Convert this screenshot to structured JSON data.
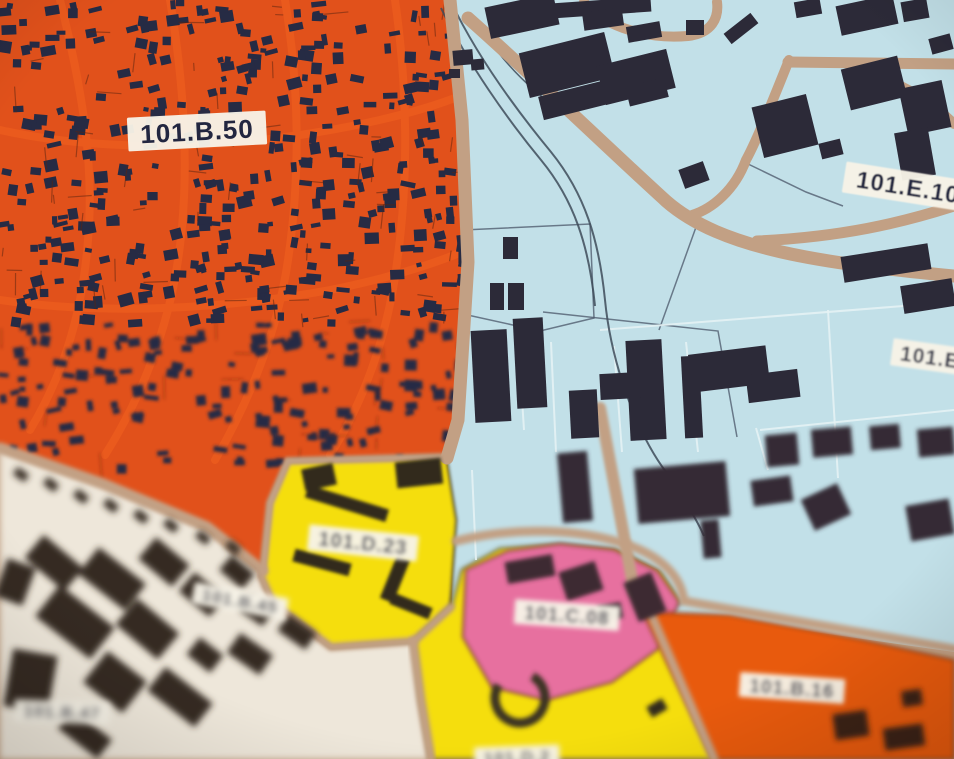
{
  "map": {
    "description": "zoning-map-photo",
    "background_color": "#c2a084",
    "road_color": "#c2a084",
    "railway_color": "#3e4b59",
    "building_color_blue_zone": "#2c2a38",
    "house_color_orange_zone": "#262b44",
    "label_bg_color": "#f7f3e7",
    "label_text_color": "#222640",
    "zones": [
      {
        "id": "zone-residential-orange",
        "color": "#e1511b",
        "points": "0,0 450,0 462,120 468,262 458,420 447,458 288,461 270,503 263,571 207,527 103,484 0,448",
        "blur": 0
      },
      {
        "id": "zone-industrial-blue",
        "color": "#c2e0e8",
        "points": "450,0 954,0 954,652 800,630 651,612 678,601 658,570 614,549 560,545 508,551 466,569 461,632 452,608 453,520 447,458 458,420 468,262 462,120",
        "blur": 0
      },
      {
        "id": "zone-white-101b45",
        "color": "#eee7da",
        "points": "0,448 103,484 207,527 263,571 261,576 273,603 331,647 414,641 421,700 431,759 0,759",
        "blur": 3.5
      },
      {
        "id": "zone-yellow-101d23",
        "color": "#f5de0a",
        "points": "288,461 446,457 456,520 450,607 414,641 331,647 273,603 261,576 263,571 270,503",
        "outline": "#473c20",
        "ow": 2.5,
        "blur": 1.5
      },
      {
        "id": "zone-yellow-lower",
        "color": "#f5de0a",
        "points": "414,641 452,606 462,570 500,549 560,545 616,550 660,572 680,602 651,612 714,759 431,759 421,700",
        "outline": "#473c20",
        "ow": 2.5,
        "blur": 2.5
      },
      {
        "id": "zone-pink-101c08",
        "color": "#e7709f",
        "points": "466,570 508,551 560,544 614,550 657,571 679,602 659,648 612,682 546,700 492,687 463,637",
        "outline": "#8a4a3a",
        "ow": 2.5,
        "blur": 2
      },
      {
        "id": "zone-orange-101b16",
        "color": "#e85a10",
        "points": "643,612 730,615 863,640 954,660 954,759 713,759",
        "outline": "#7a3a14",
        "ow": 2,
        "blur": 2.5
      }
    ],
    "streets_in_orange": [
      {
        "d": "M60,0 C80,80 95,160 88,240 C82,320 60,380 30,430"
      },
      {
        "d": "M170,0 C185,90 190,180 178,260 C168,330 140,400 105,455"
      },
      {
        "d": "M285,0 C300,90 300,180 288,260 C278,330 250,400 215,460"
      },
      {
        "d": "M395,0 C408,90 408,180 398,255 C390,325 368,395 330,455"
      },
      {
        "d": "M0,130 C90,150 200,150 300,135 C360,126 420,112 460,96"
      },
      {
        "d": "M0,300 C100,315 220,310 330,290 C390,278 430,265 462,252"
      }
    ],
    "street_color": "#ea5a1d",
    "texture": {
      "seed": 7,
      "house_count": 540,
      "line_count": 90,
      "line_color": "#5a2410"
    },
    "roads": [
      {
        "d": "M450,0 L462,120 L468,262 L458,420 L447,458",
        "w": 13,
        "blur": 0
      },
      {
        "d": "M0,448 L103,484 L207,527 L263,571",
        "w": 11,
        "blur": 2
      },
      {
        "d": "M263,571 L270,503 L288,461 L446,457",
        "w": 8,
        "blur": 1.5
      },
      {
        "d": "M261,576 L273,603 L331,647 L414,641 L451,607",
        "w": 8,
        "blur": 2
      },
      {
        "d": "M413,641 L421,700 L431,759",
        "w": 9,
        "blur": 2.5
      },
      {
        "d": "M468,18 C540,82 612,152 666,201 C722,250 822,263 954,276",
        "w": 13,
        "blur": 0
      },
      {
        "d": "M757,241 C842,237 901,223 954,206",
        "w": 11,
        "blur": 0
      },
      {
        "d": "M788,62 L954,64",
        "w": 11,
        "blur": 0
      },
      {
        "d": "M850,66 C902,82 932,102 954,124",
        "w": 10,
        "blur": 0
      },
      {
        "d": "M789,60 C775,95 757,140 746,160 C735,190 712,209 692,215",
        "w": 10,
        "blur": 0
      },
      {
        "d": "M584,2 C598,22 640,40 688,36 C712,33 719,18 717,2",
        "w": 10,
        "blur": 0
      },
      {
        "d": "M600,408 L634,590",
        "w": 12,
        "blur": 1.5
      },
      {
        "d": "M456,541 C505,529 565,527 615,541 C660,553 681,576 684,601 L954,649",
        "w": 9,
        "blur": 2
      },
      {
        "d": "M651,614 L714,759",
        "w": 9,
        "blur": 2.5
      }
    ],
    "railways": [
      {
        "d": "M451,2 C478,58 518,112 551,152 C585,194 599,240 605,300 C611,362 636,432 666,472 C681,494 696,518 704,536",
        "w": 2
      },
      {
        "d": "M441,8 C468,64 508,120 541,160 C574,200 589,246 595,306",
        "w": 2
      },
      {
        "d": "M498,52 C520,80 548,104 575,120",
        "w": 1.5
      }
    ],
    "parcel_lines_light": [
      {
        "d": "M600,330 L954,302"
      },
      {
        "d": "M524,430 L518,336"
      },
      {
        "d": "M556,452 L551,342"
      },
      {
        "d": "M622,452 L614,346"
      },
      {
        "d": "M698,452 L686,342"
      },
      {
        "d": "M768,470 L756,428"
      },
      {
        "d": "M838,478 L828,310"
      },
      {
        "d": "M760,430 L954,410"
      },
      {
        "d": "M476,560 L472,470"
      }
    ],
    "parcel_lines_dark": [
      {
        "d": "M463,230 L590,224 L594,318 L540,331 L463,314 Z"
      },
      {
        "d": "M543,312 L718,331 L737,437"
      },
      {
        "d": "M700,216 L659,330"
      },
      {
        "d": "M746,163 L806,192 L843,206"
      }
    ],
    "buildings": {
      "blue_sharp": [
        [
          487,
          0,
          70,
          32,
          -12
        ],
        [
          551,
          0,
          100,
          15,
          -4
        ],
        [
          583,
          10,
          40,
          18,
          -8
        ],
        [
          627,
          24,
          34,
          16,
          -10
        ],
        [
          523,
          42,
          88,
          46,
          -14
        ],
        [
          600,
          57,
          72,
          40,
          -14
        ],
        [
          540,
          88,
          70,
          24,
          -14
        ],
        [
          627,
          82,
          40,
          20,
          -14
        ],
        [
          686,
          20,
          18,
          15,
          0
        ],
        [
          724,
          22,
          34,
          13,
          -38
        ],
        [
          453,
          50,
          20,
          15,
          -5
        ],
        [
          471,
          59,
          13,
          11,
          -5
        ],
        [
          449,
          69,
          11,
          9,
          0
        ],
        [
          795,
          0,
          26,
          16,
          -10
        ],
        [
          838,
          0,
          58,
          30,
          -12
        ],
        [
          902,
          0,
          26,
          20,
          -10
        ],
        [
          845,
          62,
          58,
          42,
          -14
        ],
        [
          903,
          84,
          44,
          48,
          -12
        ],
        [
          930,
          36,
          22,
          16,
          -15
        ],
        [
          757,
          100,
          56,
          52,
          -14
        ],
        [
          820,
          141,
          22,
          16,
          -14
        ],
        [
          898,
          130,
          34,
          48,
          -10
        ],
        [
          681,
          165,
          26,
          20,
          -20
        ],
        [
          842,
          250,
          88,
          26,
          -9
        ],
        [
          902,
          282,
          52,
          28,
          -9
        ],
        [
          690,
          350,
          78,
          38,
          -7
        ],
        [
          628,
          340,
          36,
          100,
          -3
        ],
        [
          683,
          356,
          18,
          82,
          -3
        ],
        [
          473,
          330,
          36,
          92,
          -3
        ],
        [
          515,
          318,
          30,
          90,
          -3
        ],
        [
          570,
          390,
          28,
          48,
          -3
        ],
        [
          600,
          373,
          40,
          26,
          -3
        ],
        [
          747,
          372,
          52,
          28,
          -7
        ],
        [
          503,
          237,
          15,
          22,
          0
        ],
        [
          490,
          283,
          14,
          27,
          0
        ],
        [
          508,
          283,
          16,
          27,
          0
        ],
        [
          688,
          388,
          10,
          8,
          0
        ]
      ],
      "blue_blurred": [
        [
          560,
          452,
          30,
          70,
          -5
        ],
        [
          636,
          465,
          92,
          55,
          -5
        ],
        [
          702,
          520,
          18,
          38,
          -5
        ],
        [
          752,
          478,
          40,
          26,
          -8
        ],
        [
          806,
          490,
          40,
          34,
          -25
        ],
        [
          908,
          502,
          44,
          36,
          -10
        ],
        [
          766,
          434,
          32,
          32,
          -5
        ],
        [
          812,
          428,
          40,
          28,
          -5
        ],
        [
          870,
          425,
          30,
          24,
          -5
        ],
        [
          918,
          428,
          36,
          28,
          -5
        ]
      ],
      "yellow_upper": [
        [
          303,
          466,
          32,
          22,
          -12
        ],
        [
          396,
          460,
          46,
          26,
          -6
        ],
        [
          305,
          497,
          84,
          13,
          17
        ],
        [
          293,
          556,
          58,
          13,
          15
        ],
        [
          388,
          556,
          14,
          46,
          22
        ],
        [
          390,
          600,
          42,
          12,
          22
        ]
      ],
      "yellow_lower": [
        [
          648,
          702,
          18,
          12,
          -30
        ]
      ],
      "pink": [
        [
          506,
          558,
          48,
          22,
          -10
        ],
        [
          562,
          566,
          38,
          30,
          -18
        ],
        [
          630,
          576,
          30,
          42,
          -22
        ],
        [
          598,
          604,
          24,
          16,
          -10
        ]
      ],
      "white": [
        [
          28,
          548,
          52,
          30,
          40
        ],
        [
          82,
          562,
          60,
          34,
          38
        ],
        [
          142,
          548,
          44,
          28,
          40
        ],
        [
          40,
          602,
          70,
          40,
          38
        ],
        [
          120,
          612,
          55,
          34,
          40
        ],
        [
          182,
          582,
          40,
          25,
          40
        ],
        [
          222,
          562,
          30,
          20,
          40
        ],
        [
          8,
          652,
          45,
          58,
          10
        ],
        [
          90,
          662,
          50,
          40,
          38
        ],
        [
          150,
          682,
          60,
          30,
          38
        ],
        [
          230,
          642,
          40,
          24,
          35
        ],
        [
          280,
          622,
          34,
          20,
          35
        ],
        [
          60,
          722,
          50,
          24,
          38
        ],
        [
          0,
          562,
          30,
          40,
          20
        ],
        [
          242,
          602,
          28,
          18,
          35
        ],
        [
          190,
          644,
          30,
          22,
          38
        ],
        [
          14,
          470,
          14,
          9,
          35
        ],
        [
          44,
          480,
          14,
          9,
          38
        ],
        [
          74,
          492,
          14,
          9,
          38
        ],
        [
          104,
          501,
          14,
          9,
          38
        ],
        [
          134,
          512,
          14,
          9,
          38
        ],
        [
          164,
          521,
          14,
          9,
          38
        ],
        [
          196,
          533,
          14,
          9,
          38
        ],
        [
          226,
          543,
          14,
          9,
          38
        ]
      ],
      "orange_lower": [
        [
          834,
          712,
          34,
          26,
          -8
        ],
        [
          884,
          726,
          40,
          22,
          -8
        ],
        [
          902,
          690,
          20,
          16,
          -8
        ]
      ]
    },
    "building_colors": {
      "blue_sharp": "#2c2a38",
      "blue_blurred": "#342c34",
      "yellow_upper": "#332c1e",
      "yellow_lower": "#332c1e",
      "pink": "#3c2a33",
      "white": "#362c22",
      "orange_lower": "#3a2415"
    },
    "building_blurs": {
      "blue_sharp": 0,
      "blue_blurred": 2,
      "yellow_upper": 1.5,
      "yellow_lower": 2.5,
      "pink": 2,
      "white": 3.5,
      "orange_lower": 3
    },
    "ring": {
      "cx": 520,
      "cy": 698,
      "r": 25,
      "w": 9,
      "color": "#3a3322",
      "dash": "118 39",
      "rot": -60,
      "blur": 2.5
    },
    "labels": [
      {
        "text": "101.B.50",
        "x": 197,
        "y": 131,
        "rot": -3,
        "size": 26,
        "blur": 0
      },
      {
        "text": "101.E.10",
        "x": 908,
        "y": 187,
        "rot": 9,
        "size": 24,
        "blur": 0.5
      },
      {
        "text": "101.E",
        "x": 930,
        "y": 357,
        "rot": 8,
        "size": 21,
        "blur": 1
      },
      {
        "text": "101.D.23",
        "x": 363,
        "y": 543,
        "rot": 6,
        "size": 20,
        "blur": 2
      },
      {
        "text": "101.C.08",
        "x": 567,
        "y": 615,
        "rot": 4,
        "size": 19,
        "blur": 2.5
      },
      {
        "text": "101.B.16",
        "x": 792,
        "y": 688,
        "rot": 4,
        "size": 19,
        "blur": 2.5
      },
      {
        "text": "101.B.45",
        "x": 240,
        "y": 601,
        "rot": 10,
        "size": 17,
        "blur": 3
      },
      {
        "text": "101.B.47",
        "x": 62,
        "y": 712,
        "rot": 2,
        "size": 17,
        "blur": 3.5
      },
      {
        "text": "101.D.2",
        "x": 517,
        "y": 757,
        "rot": -2,
        "size": 17,
        "blur": 3
      }
    ]
  }
}
